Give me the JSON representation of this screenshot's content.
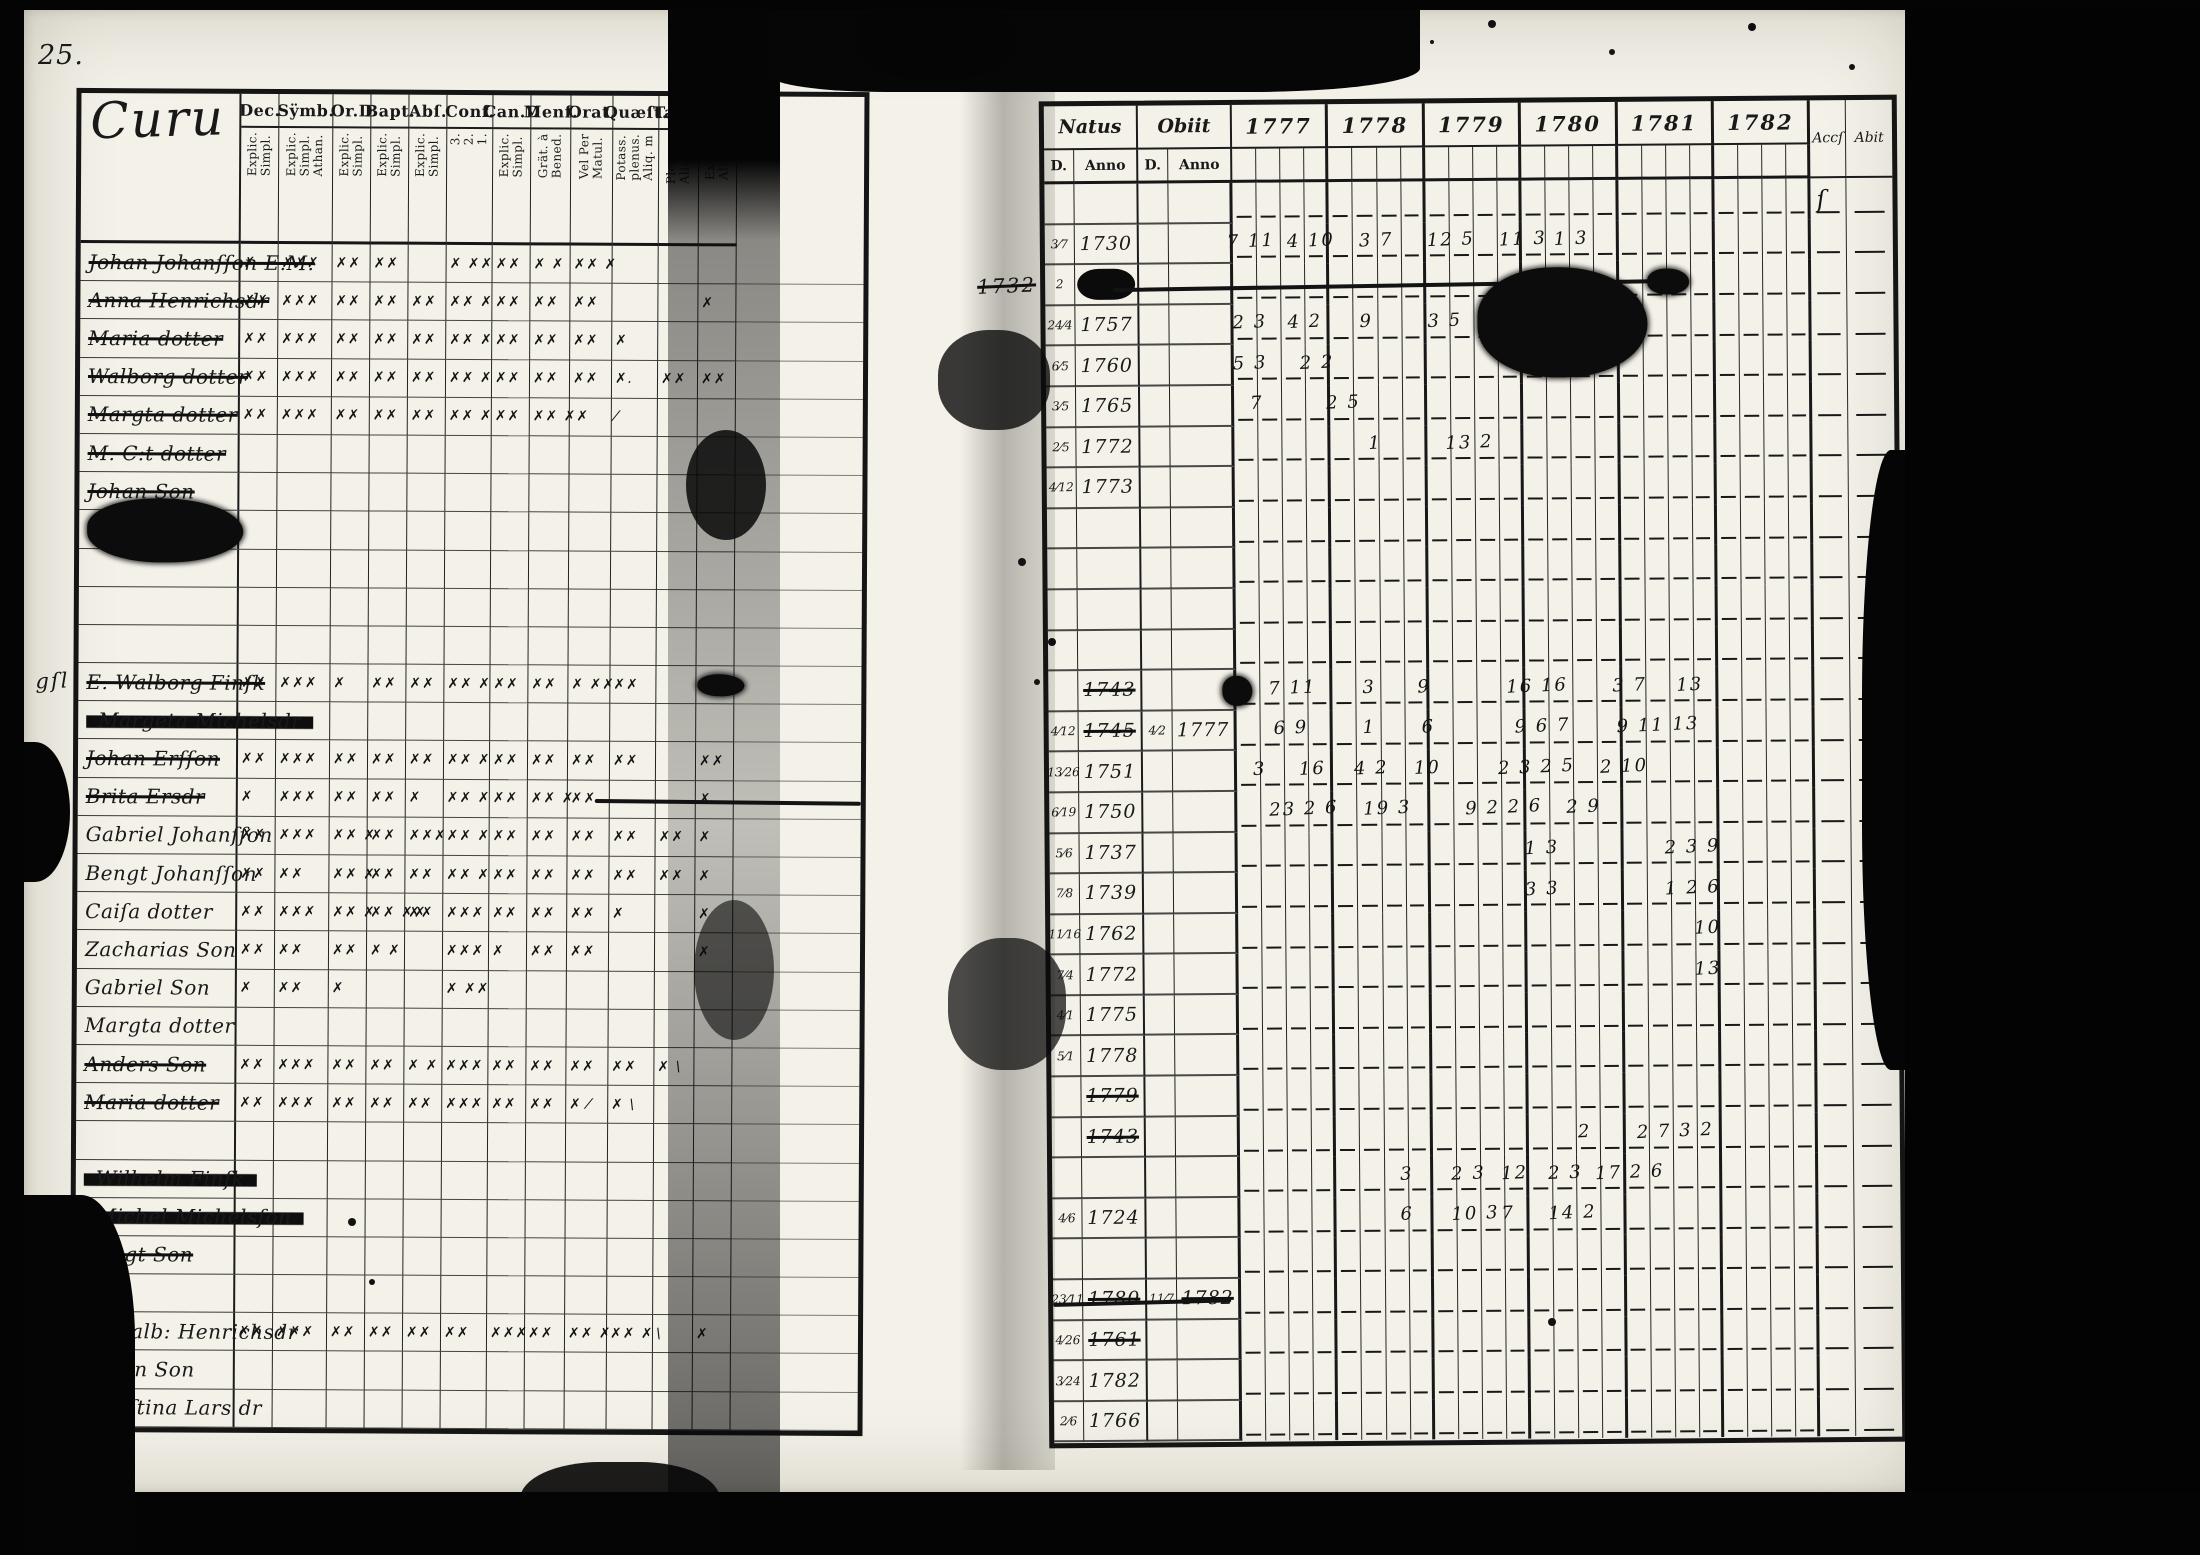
{
  "page": {
    "corner_number": "25.",
    "background": "#060606",
    "paper": "#f3f1e8",
    "ink": "#191919"
  },
  "left_table": {
    "title": "Curu",
    "columns": [
      {
        "label": "Dec.",
        "sub": "Explic.\nSimpl."
      },
      {
        "label": "Sÿmb.",
        "sub": "Explic.\nSimpl.\nAthan."
      },
      {
        "label": "Or.D",
        "sub": "Explic.\nSimpl."
      },
      {
        "label": "Bapt.",
        "sub": "Explic.\nSimpl."
      },
      {
        "label": "Abſ.",
        "sub": "Explic.\nSimpl."
      },
      {
        "label": "Conf.",
        "sub": "3.\n2.\n1."
      },
      {
        "label": "Can.D",
        "sub": "Explic.\nSimpl."
      },
      {
        "label": "Menſ.",
        "sub": "Grät. à\nBened."
      },
      {
        "label": "Orat.",
        "sub": "Vel Per\nMatul."
      },
      {
        "label": "Quæſt.",
        "sub": "Potass.\nplenus.\nAliq. m"
      },
      {
        "label": "Tabb.",
        "sub": "Plenus.\nAliq. m."
      },
      {
        "label": "L.n",
        "sub": "Exact.\nAliq.m."
      }
    ],
    "rows": [
      {
        "name": "Johan Johanſſon E.M.",
        "s": 1,
        "m": [
          "✗",
          "✗✗✗",
          "✗✗",
          "✗✗",
          "",
          "✗ ✗✗",
          "✗✗",
          "✗ ✗",
          "✗✗ ✗",
          "",
          "",
          ""
        ]
      },
      {
        "name": "Anna Henrichsdr",
        "s": 1,
        "m": [
          "✗✗",
          "✗✗✗",
          "✗✗",
          "✗✗",
          "✗✗",
          "✗✗ ✗",
          "✗✗",
          "✗✗",
          "✗✗",
          "",
          "",
          "✗"
        ]
      },
      {
        "name": "Maria dotter",
        "s": 1,
        "m": [
          "✗✗",
          "✗✗✗",
          "✗✗",
          "✗✗",
          "✗✗",
          "✗✗ ✗",
          "✗✗",
          "✗✗",
          "✗✗",
          "✗",
          "",
          ""
        ]
      },
      {
        "name": "Walborg dotter",
        "s": 1,
        "m": [
          "✗✗",
          "✗✗✗",
          "✗✗",
          "✗✗",
          "✗✗",
          "✗✗ ✗",
          "✗✗",
          "✗✗",
          "✗✗",
          "✗.",
          "✗✗",
          "✗✗"
        ]
      },
      {
        "name": "Margta dotter",
        "s": 1,
        "m": [
          "✗✗",
          "✗✗✗",
          "✗✗",
          "✗✗",
          "✗✗",
          "✗✗ ✗",
          "✗✗",
          "✗✗ ✗✗",
          "",
          "⁄",
          "",
          ""
        ]
      },
      {
        "name": "M. C:t dotter",
        "s": 1,
        "m": [
          "",
          "",
          "",
          "",
          "",
          "",
          "",
          "",
          "",
          "",
          "",
          ""
        ]
      },
      {
        "name": "Johan Son",
        "s": 1,
        "m": [
          "",
          "",
          "",
          "",
          "",
          "",
          "",
          "",
          "",
          "",
          "",
          ""
        ]
      },
      {
        "name": "",
        "s": 0
      },
      {
        "name": "",
        "s": 0
      },
      {
        "name": "",
        "s": 0
      },
      {
        "name": "",
        "s": 0
      },
      {
        "name": "E. Walborg Finſk",
        "s": 1,
        "m": [
          "✗✗",
          "✗✗✗",
          "✗",
          "✗✗",
          "✗✗",
          "✗✗ ✗",
          "✗✗",
          "✗✗",
          "✗ ✗✗",
          "✗✗",
          "",
          ""
        ]
      },
      {
        "name": "Margeta Michelsdr",
        "s": 2,
        "m": [
          "",
          "",
          "",
          "",
          "",
          "",
          "",
          "",
          "",
          "",
          "",
          ""
        ]
      },
      {
        "name": "Johan Erſſon",
        "s": 1,
        "m": [
          "✗✗",
          "✗✗✗",
          "✗✗",
          "✗✗",
          "✗✗",
          "✗✗ ✗",
          "✗✗",
          "✗✗",
          "✗✗",
          "✗✗",
          "",
          "✗✗"
        ]
      },
      {
        "name": "Brita Ersdr",
        "s": 1,
        "m": [
          "✗",
          "✗✗✗",
          "✗✗",
          "✗✗",
          "✗",
          "✗✗ ✗",
          "✗✗",
          "✗✗ ✗",
          "✗✗",
          "",
          "",
          "✗"
        ]
      },
      {
        "name": "Gabriel Johanſſon",
        "s": 0,
        "m": [
          "✗✗",
          "✗✗✗",
          "✗✗ ✗",
          "✗✗",
          "✗✗✗",
          "✗✗ ✗",
          "✗✗",
          "✗✗",
          "✗✗",
          "✗✗",
          "✗✗",
          "✗"
        ]
      },
      {
        "name": "Bengt Johanſſon",
        "s": 0,
        "m": [
          "✗✗",
          "✗✗",
          "✗✗ ✗",
          "✗✗",
          "✗✗",
          "✗✗ ✗",
          "✗✗",
          "✗✗",
          "✗✗",
          "✗✗",
          "✗✗",
          "✗"
        ]
      },
      {
        "name": "Caiſa dotter",
        "s": 0,
        "m": [
          "✗✗",
          "✗✗✗",
          "✗✗ ✗",
          "✗✗ ✗✗",
          "✗✗",
          "✗✗✗",
          "✗✗",
          "✗✗",
          "✗✗",
          "✗",
          "",
          "✗"
        ]
      },
      {
        "name": "Zacharias Son",
        "s": 0,
        "m": [
          "✗✗",
          "✗✗",
          "✗✗",
          "✗ ✗",
          "",
          "✗✗✗",
          "✗",
          "✗✗",
          "✗✗",
          "",
          "",
          "✗"
        ]
      },
      {
        "name": "Gabriel Son",
        "s": 0,
        "m": [
          "✗",
          "✗✗",
          "✗",
          "",
          "",
          "✗ ✗✗",
          "",
          "",
          "",
          "",
          "",
          ""
        ]
      },
      {
        "name": "Margta dotter",
        "s": 0,
        "m": [
          "",
          "",
          "",
          "",
          "",
          "",
          "",
          "",
          "",
          "",
          "",
          ""
        ]
      },
      {
        "name": "Anders Son",
        "s": 1,
        "m": [
          "✗✗",
          "✗✗✗",
          "✗✗",
          "✗✗",
          "✗ ✗",
          "✗✗✗",
          "✗✗",
          "✗✗",
          "✗✗",
          "✗✗",
          "✗ \\",
          ""
        ]
      },
      {
        "name": "Maria dotter",
        "s": 1,
        "m": [
          "✗✗",
          "✗✗✗",
          "✗✗",
          "✗✗",
          "✗✗",
          "✗✗✗",
          "✗✗",
          "✗✗",
          "✗ ⁄",
          "✗ \\",
          "",
          ""
        ]
      },
      {
        "name": "",
        "s": 0
      },
      {
        "name": "Wilhelm Finſk",
        "s": 2
      },
      {
        "name": "Michel Michelsſon",
        "s": 2
      },
      {
        "name": "Bengt Son",
        "s": 1
      },
      {
        "name": "",
        "s": 0
      },
      {
        "name": "E. Walb: Henrichsdr",
        "s": 0,
        "m": [
          "✗✗",
          "✗✗✗",
          "✗✗",
          "✗✗",
          "✗✗",
          "✗✗",
          "✗✗✗",
          "✗✗",
          "✗✗ ✗",
          "✗✗ ✗",
          "\\",
          "✗"
        ]
      },
      {
        "name": "Göran Son",
        "s": 0
      },
      {
        "name": "Chriſtina Lars dr",
        "s": 0
      }
    ],
    "annotations": [
      {
        "t": "blob",
        "row": 7,
        "x": 1,
        "w": 20,
        "h": 64
      },
      {
        "t": "text",
        "row": 11,
        "x": -5.5,
        "text": "gſl",
        "size": 21
      },
      {
        "t": "blob",
        "row": 11,
        "x": 79,
        "w": 6,
        "h": 22
      },
      {
        "t": "line",
        "row": 14,
        "x": 66,
        "w": 34,
        "rot": 0.3
      },
      {
        "t": "text",
        "row": 25,
        "x": -5,
        "text": "g",
        "size": 20
      },
      {
        "t": "text",
        "row": 26,
        "x": -4.5,
        "text": "6",
        "size": 19
      }
    ]
  },
  "right_table": {
    "natus_label": "Natus",
    "obiit_label": "Obiit",
    "day_label": "D.",
    "anno_label": "Anno",
    "years": [
      "1777",
      "1778",
      "1779",
      "1780",
      "1781",
      "1782"
    ],
    "accs_label": "Accſ",
    "abit_label": "Abit",
    "rows": [
      {},
      {
        "nd": "3⁄7",
        "na": "1730"
      },
      {
        "nd": "2",
        "na": "",
        "redacted": true
      },
      {
        "nd": "24⁄4",
        "na": "1757"
      },
      {
        "nd": "6⁄5",
        "na": "1760"
      },
      {
        "nd": "3⁄5",
        "na": "1765"
      },
      {
        "nd": "2⁄5",
        "na": "1772"
      },
      {
        "nd": "4⁄12",
        "na": "1773"
      },
      {},
      {},
      {},
      {},
      {
        "na": "1743",
        "ns": 1
      },
      {
        "nd": "4⁄12",
        "na": "1745",
        "od": "4⁄2",
        "oa": "1777",
        "ns": 1
      },
      {
        "nd": "13⁄26",
        "na": "1751"
      },
      {
        "nd": "6⁄19",
        "na": "1750"
      },
      {
        "nd": "5⁄6",
        "na": "1737"
      },
      {
        "nd": "7⁄8",
        "na": "1739"
      },
      {
        "nd": "11⁄16",
        "na": "1762"
      },
      {
        "nd": "7⁄4",
        "na": "1772"
      },
      {
        "nd": "4⁄1",
        "na": "1775"
      },
      {
        "nd": "5⁄1",
        "na": "1778"
      },
      {
        "na": "1779",
        "ns": 1
      },
      {
        "na": "1743",
        "ns": 1
      },
      {},
      {
        "nd": "4⁄6",
        "na": "1724"
      },
      {},
      {
        "nd": "23⁄11",
        "na": "1780",
        "od": "11⁄7",
        "oa": "1782",
        "ns": 1,
        "os": 1
      },
      {
        "nd": "4⁄26",
        "na": "1761",
        "ns": 1
      },
      {
        "nd": "3⁄24",
        "na": "1782"
      },
      {
        "nd": "2⁄6",
        "na": "1766"
      }
    ],
    "annotations": [
      {
        "t": "text",
        "row": 1,
        "x": 21.5,
        "text": "7 11"
      },
      {
        "t": "text",
        "row": 1,
        "x": 28.5,
        "text": "4 10"
      },
      {
        "t": "text",
        "row": 1,
        "x": 37,
        "text": "3 7"
      },
      {
        "t": "text",
        "row": 1,
        "x": 45,
        "text": "12 5"
      },
      {
        "t": "text",
        "row": 1,
        "x": 53.5,
        "text": "11 3"
      },
      {
        "t": "text",
        "row": 1,
        "x": 60,
        "text": "1 3"
      },
      {
        "t": "line",
        "row": 2,
        "x": 8,
        "w": 64,
        "rot": -0.5
      },
      {
        "t": "blob",
        "row": 3,
        "x": 51,
        "w": 20,
        "h": 110
      },
      {
        "t": "blob",
        "row": 2,
        "x": 71,
        "w": 5,
        "h": 26
      },
      {
        "t": "text",
        "row": 2,
        "x": -8,
        "text": "1732",
        "strike": true,
        "size": 20
      },
      {
        "t": "text",
        "row": 3,
        "x": 22,
        "text": "2 3"
      },
      {
        "t": "text",
        "row": 3,
        "x": 28.5,
        "text": "4 2"
      },
      {
        "t": "text",
        "row": 3,
        "x": 37,
        "text": "9"
      },
      {
        "t": "text",
        "row": 3,
        "x": 45,
        "text": "3 5"
      },
      {
        "t": "text",
        "row": 4,
        "x": 22,
        "text": "5 3"
      },
      {
        "t": "text",
        "row": 4,
        "x": 30,
        "text": "2 2"
      },
      {
        "t": "text",
        "row": 5,
        "x": 24,
        "text": "7"
      },
      {
        "t": "text",
        "row": 5,
        "x": 33,
        "text": "2 5"
      },
      {
        "t": "text",
        "row": 6,
        "x": 38,
        "text": "1"
      },
      {
        "t": "text",
        "row": 6,
        "x": 47,
        "text": "13 2"
      },
      {
        "t": "blob",
        "row": 12,
        "x": 20.5,
        "w": 3.5,
        "h": 30
      },
      {
        "t": "text",
        "row": 12,
        "x": 26,
        "text": "7 11"
      },
      {
        "t": "text",
        "row": 12,
        "x": 37,
        "text": "3"
      },
      {
        "t": "text",
        "row": 12,
        "x": 43.5,
        "text": "9"
      },
      {
        "t": "text",
        "row": 12,
        "x": 54,
        "text": "16 16"
      },
      {
        "t": "text",
        "row": 12,
        "x": 66.5,
        "text": "3 7"
      },
      {
        "t": "text",
        "row": 12,
        "x": 74,
        "text": "13"
      },
      {
        "t": "text",
        "row": 13,
        "x": 26.5,
        "text": "6 9"
      },
      {
        "t": "text",
        "row": 13,
        "x": 37,
        "text": "1"
      },
      {
        "t": "text",
        "row": 13,
        "x": 44,
        "text": "6"
      },
      {
        "t": "text",
        "row": 13,
        "x": 55,
        "text": "9 6 7"
      },
      {
        "t": "text",
        "row": 13,
        "x": 67,
        "text": "9 11 13"
      },
      {
        "t": "text",
        "row": 14,
        "x": 24,
        "text": "3"
      },
      {
        "t": "text",
        "row": 14,
        "x": 29.5,
        "text": "16"
      },
      {
        "t": "text",
        "row": 14,
        "x": 36,
        "text": "4 2"
      },
      {
        "t": "text",
        "row": 14,
        "x": 43,
        "text": "10"
      },
      {
        "t": "text",
        "row": 14,
        "x": 53,
        "text": "2 3 2 5"
      },
      {
        "t": "text",
        "row": 14,
        "x": 65,
        "text": "2 10"
      },
      {
        "t": "text",
        "row": 15,
        "x": 26,
        "text": "23 2 6"
      },
      {
        "t": "text",
        "row": 15,
        "x": 37,
        "text": "19 3"
      },
      {
        "t": "text",
        "row": 15,
        "x": 49,
        "text": "9 2 2 6"
      },
      {
        "t": "text",
        "row": 15,
        "x": 61,
        "text": "2 9"
      },
      {
        "t": "text",
        "row": 16,
        "x": 56,
        "text": "1 3"
      },
      {
        "t": "text",
        "row": 16,
        "x": 72.5,
        "text": "2 3 9"
      },
      {
        "t": "text",
        "row": 17,
        "x": 56,
        "text": "3 3"
      },
      {
        "t": "text",
        "row": 17,
        "x": 72.5,
        "text": "1 2 6"
      },
      {
        "t": "text",
        "row": 18,
        "x": 76,
        "text": "10"
      },
      {
        "t": "text",
        "row": 19,
        "x": 76,
        "text": "13"
      },
      {
        "t": "text",
        "row": 23,
        "x": 62,
        "text": "2"
      },
      {
        "t": "text",
        "row": 23,
        "x": 69,
        "text": "2 7 3 2"
      },
      {
        "t": "text",
        "row": 24,
        "x": 41,
        "text": "3"
      },
      {
        "t": "text",
        "row": 24,
        "x": 47,
        "text": "2 3"
      },
      {
        "t": "text",
        "row": 24,
        "x": 53,
        "text": "12"
      },
      {
        "t": "text",
        "row": 24,
        "x": 58.5,
        "text": "2 3"
      },
      {
        "t": "text",
        "row": 24,
        "x": 64,
        "text": "17 2 6"
      },
      {
        "t": "text",
        "row": 25,
        "x": 41,
        "text": "6"
      },
      {
        "t": "text",
        "row": 25,
        "x": 47,
        "text": "10 3"
      },
      {
        "t": "text",
        "row": 25,
        "x": 53,
        "text": "7"
      },
      {
        "t": "text",
        "row": 25,
        "x": 58.5,
        "text": "14 2"
      },
      {
        "t": "line",
        "row": 27,
        "x": 0,
        "w": 21,
        "rot": -1
      },
      {
        "t": "text",
        "row": 0,
        "x": 91,
        "text": "ſ",
        "size": 24
      }
    ]
  }
}
